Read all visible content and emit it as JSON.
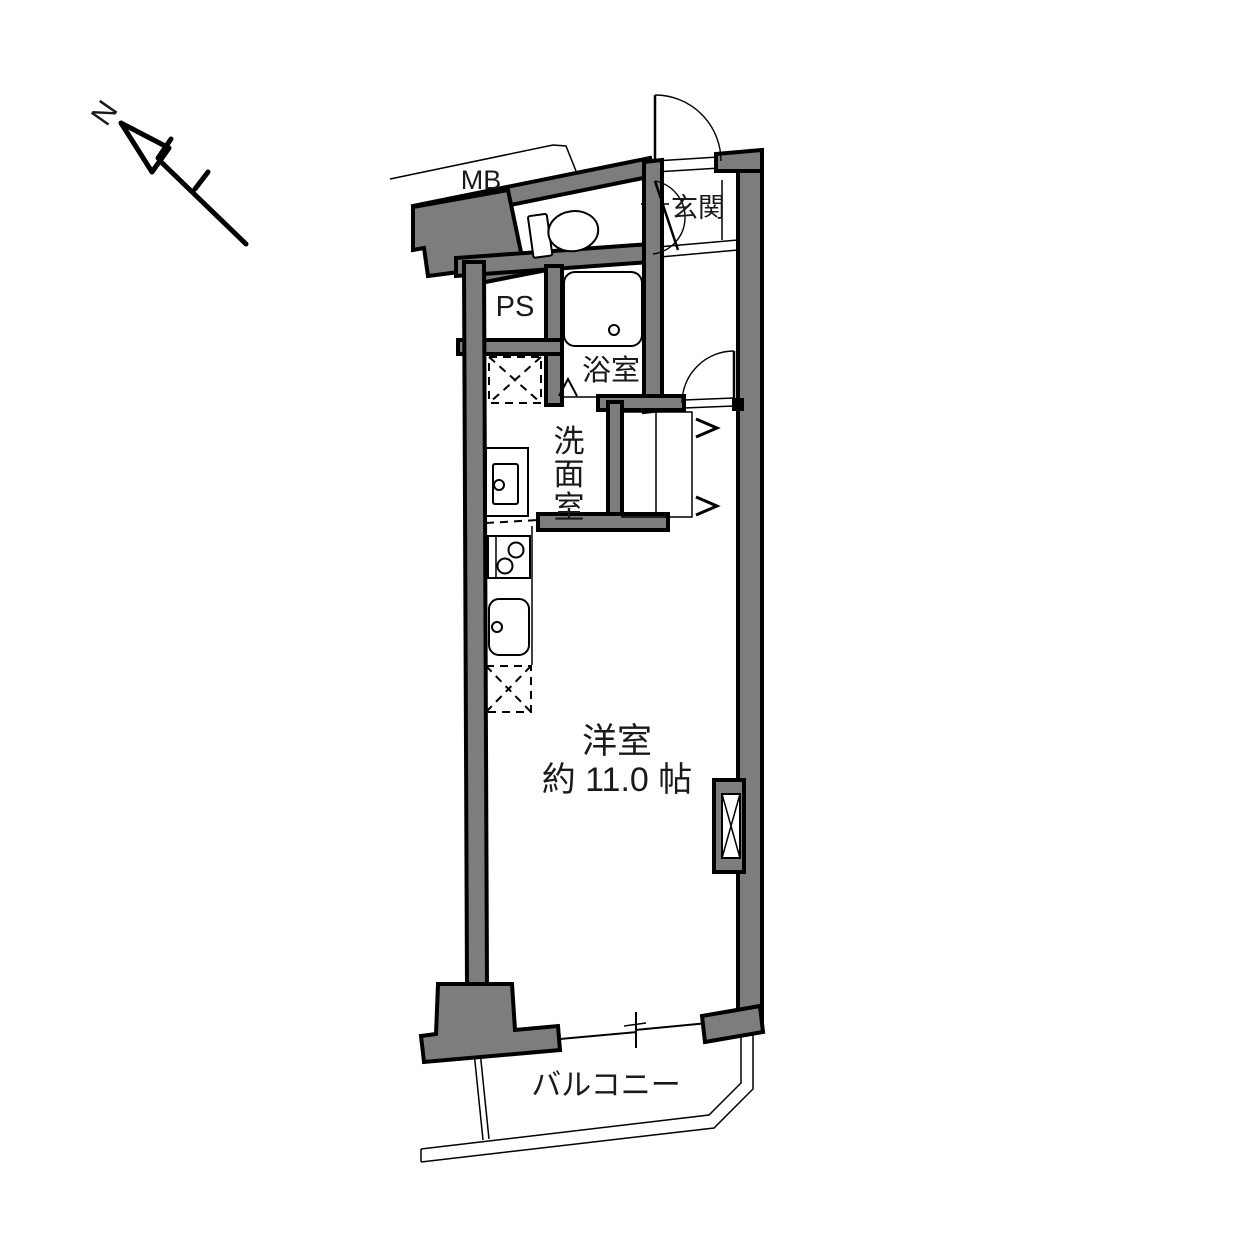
{
  "document_type": "apartment floor plan",
  "colors": {
    "wall_fill": "#7d7d7d",
    "line_color": "#000000",
    "background": "#ffffff"
  },
  "compass": {
    "north_label": "N",
    "direction": "north points upper-left"
  },
  "areas": {
    "meter_box": "MB",
    "entrance": "玄関",
    "pipe_space": "PS",
    "bathroom": "浴室",
    "washroom": "洗面室",
    "washroom_chars": [
      "洗",
      "面",
      "室"
    ],
    "living_room": "洋室",
    "living_room_size": "約 11.0 帖",
    "balcony": "バルコニー"
  },
  "fixtures": [
    "toilet",
    "bathtub",
    "washbasin-vanity",
    "gas-stove-2-burner",
    "kitchen-sink",
    "washer-pan-dashed",
    "fridge-space-dashed",
    "closet-with-right-opening-doors",
    "entrance-door",
    "toilet-door",
    "washroom-door",
    "sliding-window-to-balcony",
    "duct-shaft-x-box"
  ]
}
